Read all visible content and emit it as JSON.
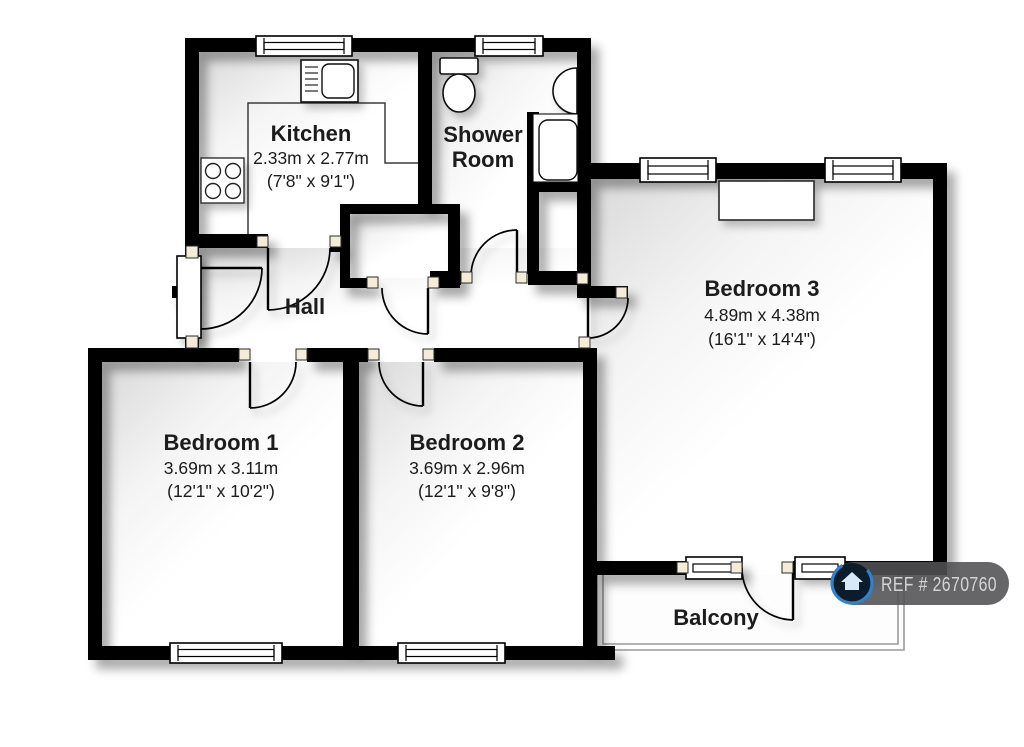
{
  "title": "Floor plan",
  "floorplan": {
    "rooms": [
      {
        "id": "kitchen",
        "name": "Kitchen",
        "metric": "2.33m x 2.77m",
        "imperial": "(7'8\" x 9'1\")"
      },
      {
        "id": "shower-room",
        "name": "Shower Room",
        "name_lines": [
          "Shower",
          "Room"
        ]
      },
      {
        "id": "hall",
        "name": "Hall"
      },
      {
        "id": "bedroom-1",
        "name": "Bedroom 1",
        "metric": "3.69m x 3.11m",
        "imperial": "(12'1\" x 10'2\")"
      },
      {
        "id": "bedroom-2",
        "name": "Bedroom 2",
        "metric": "3.69m x 2.96m",
        "imperial": "(12'1\" x 9'8\")"
      },
      {
        "id": "bedroom-3",
        "name": "Bedroom 3",
        "metric": "4.89m x 4.38m",
        "imperial": "(16'1\" x 14'4\")"
      },
      {
        "id": "balcony",
        "name": "Balcony"
      }
    ],
    "fixtures": [
      "kitchen-sink",
      "hob",
      "kitchen-counter",
      "toilet",
      "wash-basin",
      "shower-tray",
      "wardrobe",
      "entrance-door"
    ],
    "ref_badge": {
      "text": "REF # 2670760",
      "logo": "home-icon"
    },
    "colors": {
      "wall": "#000000",
      "floor_shade": "#dcdcdc",
      "door_jamb": "#f2ecd8",
      "balcony_line": "#9a9a9a",
      "badge_bg": "#515154",
      "badge_text": "#d4d4d4",
      "logo_ring": "#2e83cc",
      "logo_fill": "#0d1c2a"
    }
  }
}
